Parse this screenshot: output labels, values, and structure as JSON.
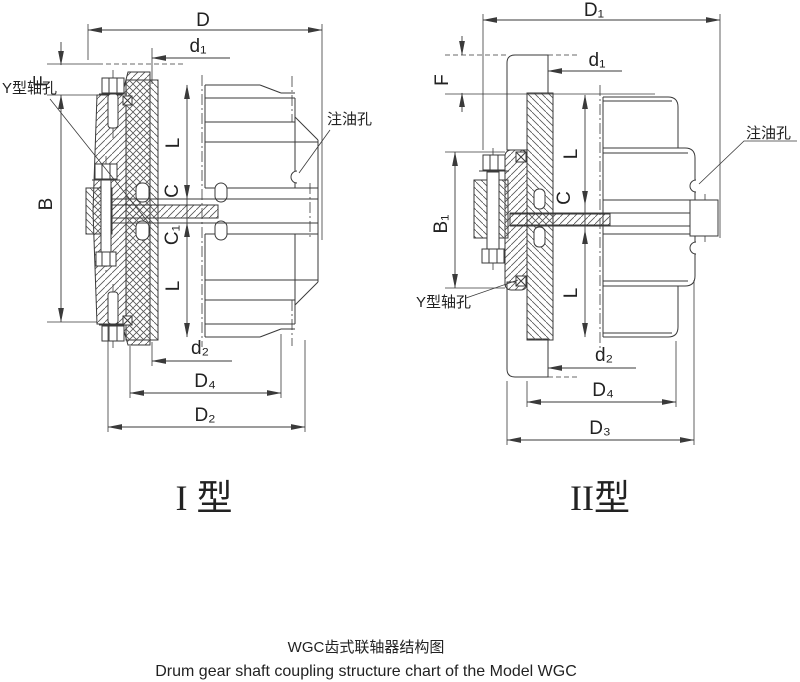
{
  "captions": {
    "title_cn": "WGC齿式联轴器结构图",
    "title_en": "Drum gear shaft coupling structure chart of the Model WGC"
  },
  "type1": {
    "name": "I 型",
    "dims": {
      "D": "D",
      "d1": "d₁",
      "F": "F",
      "B": "B",
      "L_top": "L",
      "C": "C",
      "C1": "C₁",
      "L_bottom": "L",
      "d2": "d₂",
      "D4": "D₄",
      "D2": "D₂"
    },
    "notes": {
      "shaft_hole": "Y型轴孔",
      "oil_hole": "注油孔"
    }
  },
  "type2": {
    "name": "II型",
    "dims": {
      "D1": "D₁",
      "d1": "d₁",
      "F": "F",
      "B1": "B₁",
      "L_top": "L",
      "C": "C",
      "L_bottom": "L",
      "d2": "d₂",
      "D4": "D₄",
      "D3": "D₃"
    },
    "notes": {
      "shaft_hole": "Y型轴孔",
      "oil_hole": "注油孔"
    }
  },
  "colors": {
    "line": "#3a3a3a",
    "text": "#222222",
    "background": "#ffffff"
  }
}
